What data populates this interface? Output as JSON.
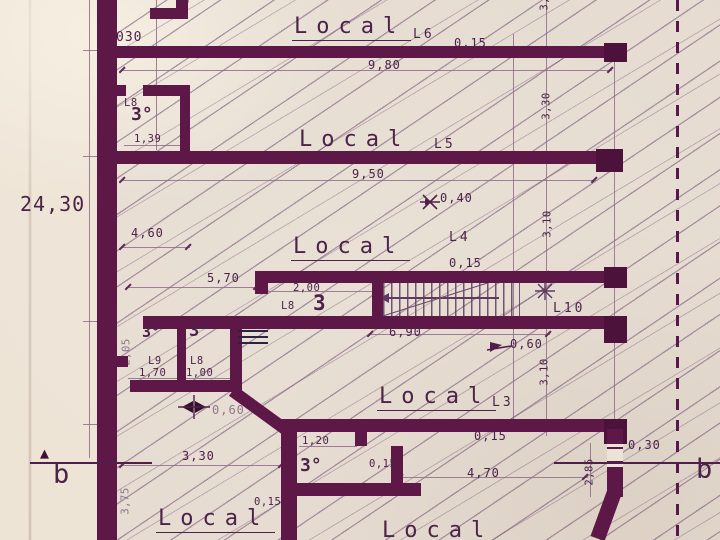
{
  "labels": {
    "l6_partial": "L6",
    "dim_030_top": "030",
    "local_a": "Local",
    "code_l6": "L6",
    "dim_015_a": "0,15",
    "dim_980": "9,80",
    "dim_340_rot": "3,40",
    "lab_l8_top": "L8",
    "bano_top": "3°",
    "dim_139": "1,39",
    "local_b": "Local",
    "code_l5": "L5",
    "dim_950": "9,50",
    "dim_330_rot": "3,30",
    "dim_040": "0,40",
    "dim_460": "4,60",
    "code_l4": "L4",
    "local_c": "Local",
    "dim_015_b": "0,15",
    "dim_310_rot_a": "3,10",
    "dim_570": "5,70",
    "dim_200": "2,00",
    "lab_l8_mid": "L8",
    "bano_mid": "3",
    "code_l10": "L10",
    "dim_690": "6,90",
    "dim_060_a": "0,60",
    "dim_310_rot_b": "3,10",
    "bano_l9": "3°",
    "bano_l8b": "3°",
    "dim_205_rot": "2,05",
    "lab_l9": "L9",
    "dim_170": "1,70",
    "lab_l8_b": "L8",
    "dim_100": "1,00",
    "dim_060_b": "0,60",
    "local_d": "Local",
    "code_l3": "L3",
    "dim_015_c": "0,15",
    "dim_120": "1,20",
    "bano_bot": "3°",
    "dim_015_d": "0,15",
    "dim_330_b": "3,30",
    "dim_015_e": "0,15",
    "local_e": "Local",
    "local_f": "Local",
    "dim_030_r": "0,30",
    "dim_470": "4,70",
    "dim_285_rot": "2,85",
    "b_left": "b",
    "b_right": "b",
    "dim_2430": "24,30",
    "dim_375_rot": "3,75"
  },
  "icons": {
    "section_arrow": "▲",
    "star_marker": "asterisk-cross",
    "level_flag": "flag-triangle",
    "benchmark": "bowtie-cross",
    "water_level": "stacked-lines"
  }
}
